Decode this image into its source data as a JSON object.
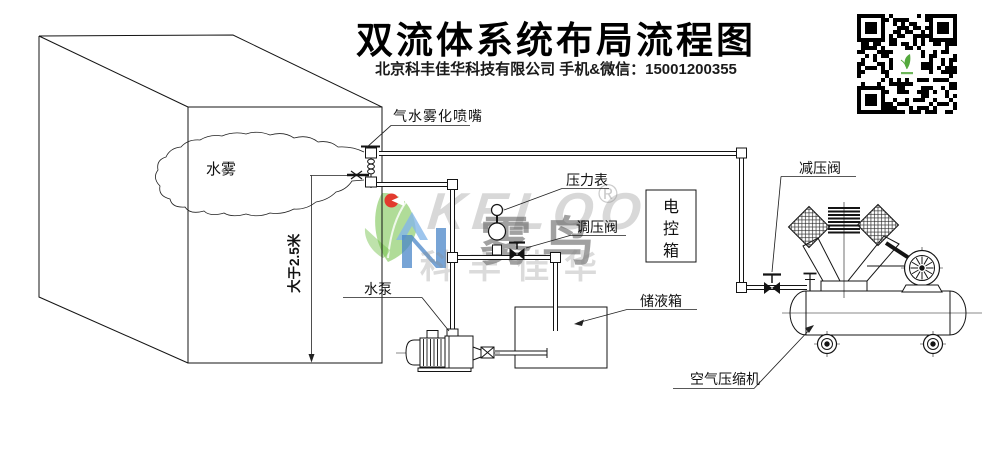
{
  "header": {
    "title": "双流体系统布局流程图",
    "subtitle": "北京科丰佳华科技有限公司 手机&微信：15001200355"
  },
  "diagram": {
    "labels": {
      "nozzle": "气水雾化喷嘴",
      "mist": "水雾",
      "height_dimension": "大于2.5米",
      "pressure_gauge": "压力表",
      "regulating_valve": "调压阀",
      "water_pump": "水泵",
      "control_box_chars": [
        "电",
        "控",
        "箱"
      ],
      "liquid_tank": "储液箱",
      "reducing_valve": "减压阀",
      "air_compressor": "空气压缩机"
    }
  },
  "watermark": {
    "brand_latin": "KELOO",
    "brand_cn": "雾鸟",
    "company": "科丰佳华",
    "registered_mark": "®"
  },
  "colors": {
    "line": "#141414",
    "watermark_green": "#6fbf44",
    "watermark_blue": "#4a86c8",
    "watermark_red": "#e23b2e",
    "qr_logo_green": "#54a93d"
  }
}
